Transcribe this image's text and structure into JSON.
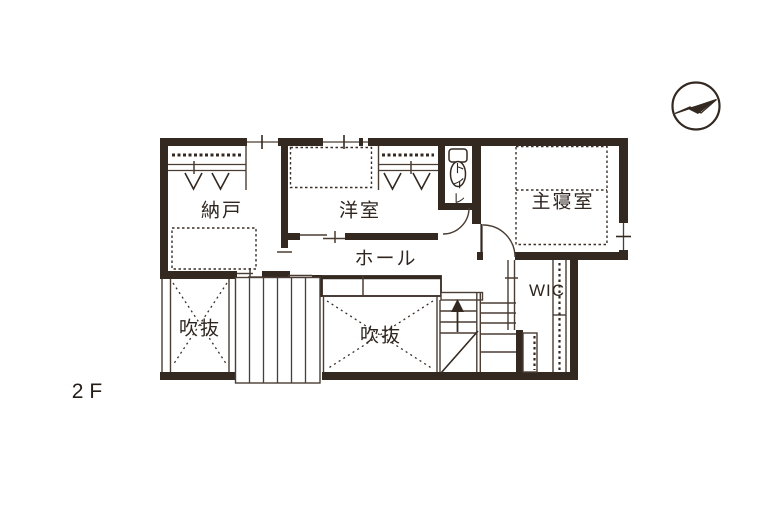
{
  "floor": {
    "label": "2F"
  },
  "rooms": {
    "nando": {
      "label": "納戸"
    },
    "yoshitsu": {
      "label": "洋室"
    },
    "toilet": {
      "label": "トイレ"
    },
    "master_bedroom": {
      "label": "主寝室"
    },
    "hall": {
      "label": "ホール"
    },
    "wic": {
      "label": "WIC"
    },
    "void_left": {
      "label": "吹抜"
    },
    "void_right": {
      "label": "吹抜"
    }
  },
  "icons": {
    "compass": "north-arrow-icon",
    "stairs": "up-arrow-icon",
    "toilet_fixture": "toilet-icon",
    "closet_hanger": "hanger-v-icon"
  },
  "colors": {
    "wall": "#342921",
    "line": "#4a3d33",
    "text": "#2f2620",
    "background": "#ffffff"
  }
}
